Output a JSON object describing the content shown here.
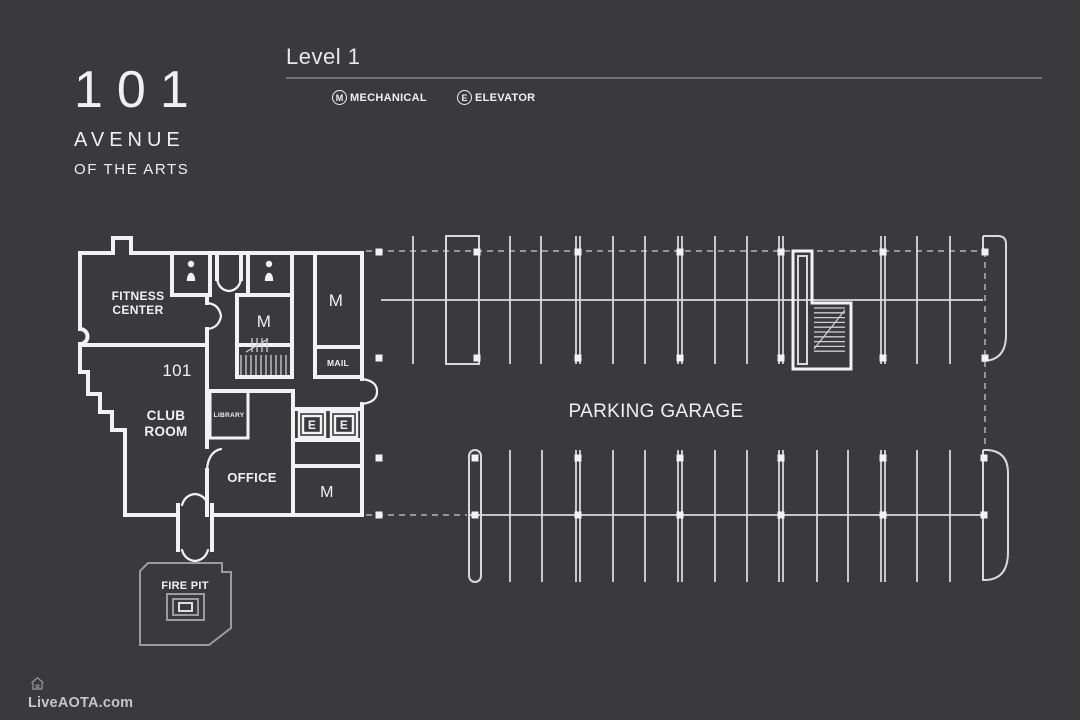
{
  "colors": {
    "background": "#3a3a3c",
    "wall": "#f2f2f2",
    "thin_line": "#d9d9d9",
    "dashed_line": "#b5b5b5",
    "muted_line": "#9c9c9c",
    "text_bright": "#f0f0f0",
    "rule": "#737373",
    "footer_text": "#c6c6c6"
  },
  "logo": {
    "number": "101",
    "line1": "AVENUE",
    "line2": "OF THE ARTS"
  },
  "header": {
    "title": "Level 1"
  },
  "legend": {
    "items": [
      {
        "symbol": "M",
        "label": "MECHANICAL"
      },
      {
        "symbol": "E",
        "label": "ELEVATOR"
      }
    ]
  },
  "plan": {
    "fitness_center": {
      "line1": "FITNESS",
      "line2": "CENTER"
    },
    "unit_number": "101",
    "club_room": {
      "line1": "CLUB",
      "line2": "ROOM"
    },
    "library": "LIBRARY",
    "office": "OFFICE",
    "mail": "MAIL",
    "mechanical_symbol": "M",
    "elevator_symbol": "E",
    "parking_garage": "PARKING GARAGE",
    "fire_pit": "FIRE PIT"
  },
  "footer": {
    "site": "LiveAOTA.com"
  }
}
